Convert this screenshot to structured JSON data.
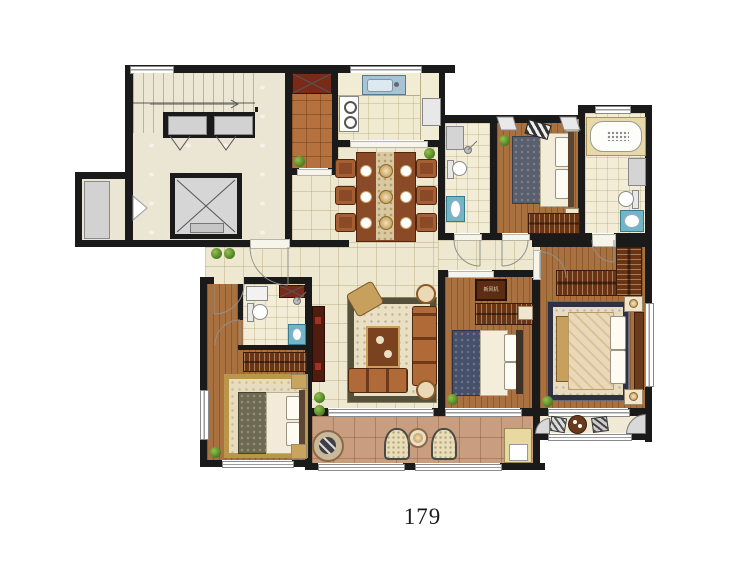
{
  "page_number": "179",
  "labels": {
    "ac_unit": "新风机"
  },
  "palette": {
    "wall": "#1a1a1a",
    "floor_tile": "#efe8d0",
    "bath_tile": "#f3edd8",
    "lobby_marble": "#ebe5d3",
    "wood_floor": "#a9713f",
    "balcony_tile": "#c99e80",
    "utility_tile": "#b5713e",
    "furniture_wood": "#8a4a28",
    "wardrobe_wood": "#6b3414",
    "fixture_teal": "#6fb7c4",
    "plant_green": "#4c7a20",
    "elevator_gray": "#d2d2d2"
  }
}
